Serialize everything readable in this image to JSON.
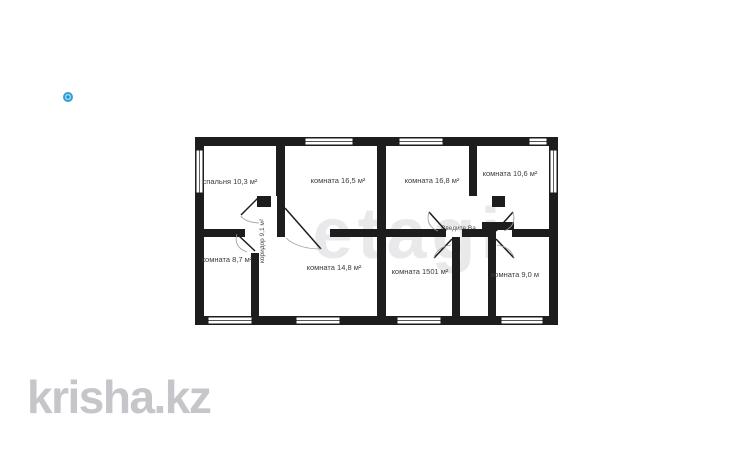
{
  "page": {
    "background": "#ffffff"
  },
  "pin_icon": {
    "color": "#2e9fd9"
  },
  "floorplan": {
    "wall_color": "#1d1d1d",
    "editor_watermark": "etagi",
    "editor_placeholder": "Введите Ва",
    "rooms": [
      {
        "name": "спальня",
        "label": "спальня 10,3 м²"
      },
      {
        "name": "комната",
        "label": "комната 16,5 м²"
      },
      {
        "name": "комната",
        "label": "комната 16,8 м²"
      },
      {
        "name": "комната",
        "label": "комната 10,6 м²"
      },
      {
        "name": "комната",
        "label": "комната 8,7 м²"
      },
      {
        "name": "комната",
        "label": "комната 14,8 м²"
      },
      {
        "name": "комната",
        "label": "комната 1501 м²"
      },
      {
        "name": "комната",
        "label": "комната 9,0 м"
      },
      {
        "name": "коридор",
        "label": "коридор 9,1 м²"
      }
    ]
  },
  "brand_watermark": {
    "text": "krisha.kz",
    "color": "#c6c6ca"
  }
}
